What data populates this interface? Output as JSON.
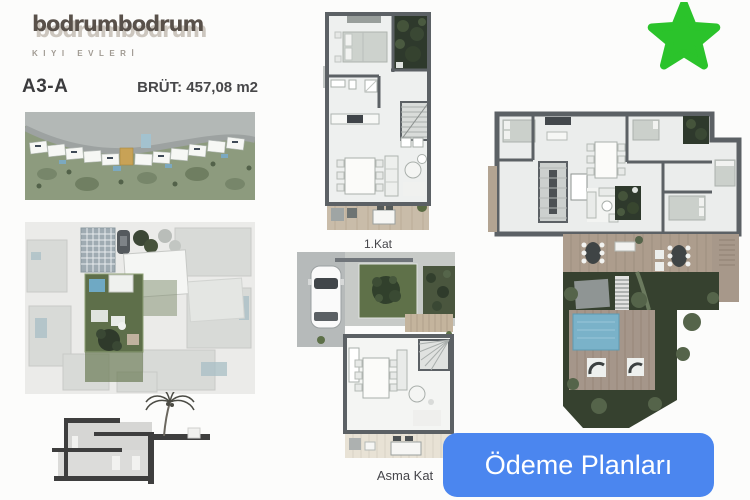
{
  "brand": {
    "name": "bodrumbodrum",
    "tagline": "KIYI EVLERİ"
  },
  "unit": {
    "code": "A3-A",
    "gross_area": "BRÜT: 457,08 m2"
  },
  "plan_labels": {
    "first_floor": "1.Kat",
    "mezzanine": "Asma Kat"
  },
  "cta": {
    "label": "Ödeme Planları"
  },
  "icons": {
    "favorite": "star-icon"
  },
  "colors": {
    "cta_blue": "#4b86ef",
    "star_green": "#2bc32b",
    "highlight_gold": "#c8a256",
    "garden_dark": "#2e392c",
    "garden_mid": "#5f7149",
    "pool_blue": "#7ab2c9",
    "deck_wood": "#ad9d8d",
    "wall_gray": "#5c6165"
  }
}
